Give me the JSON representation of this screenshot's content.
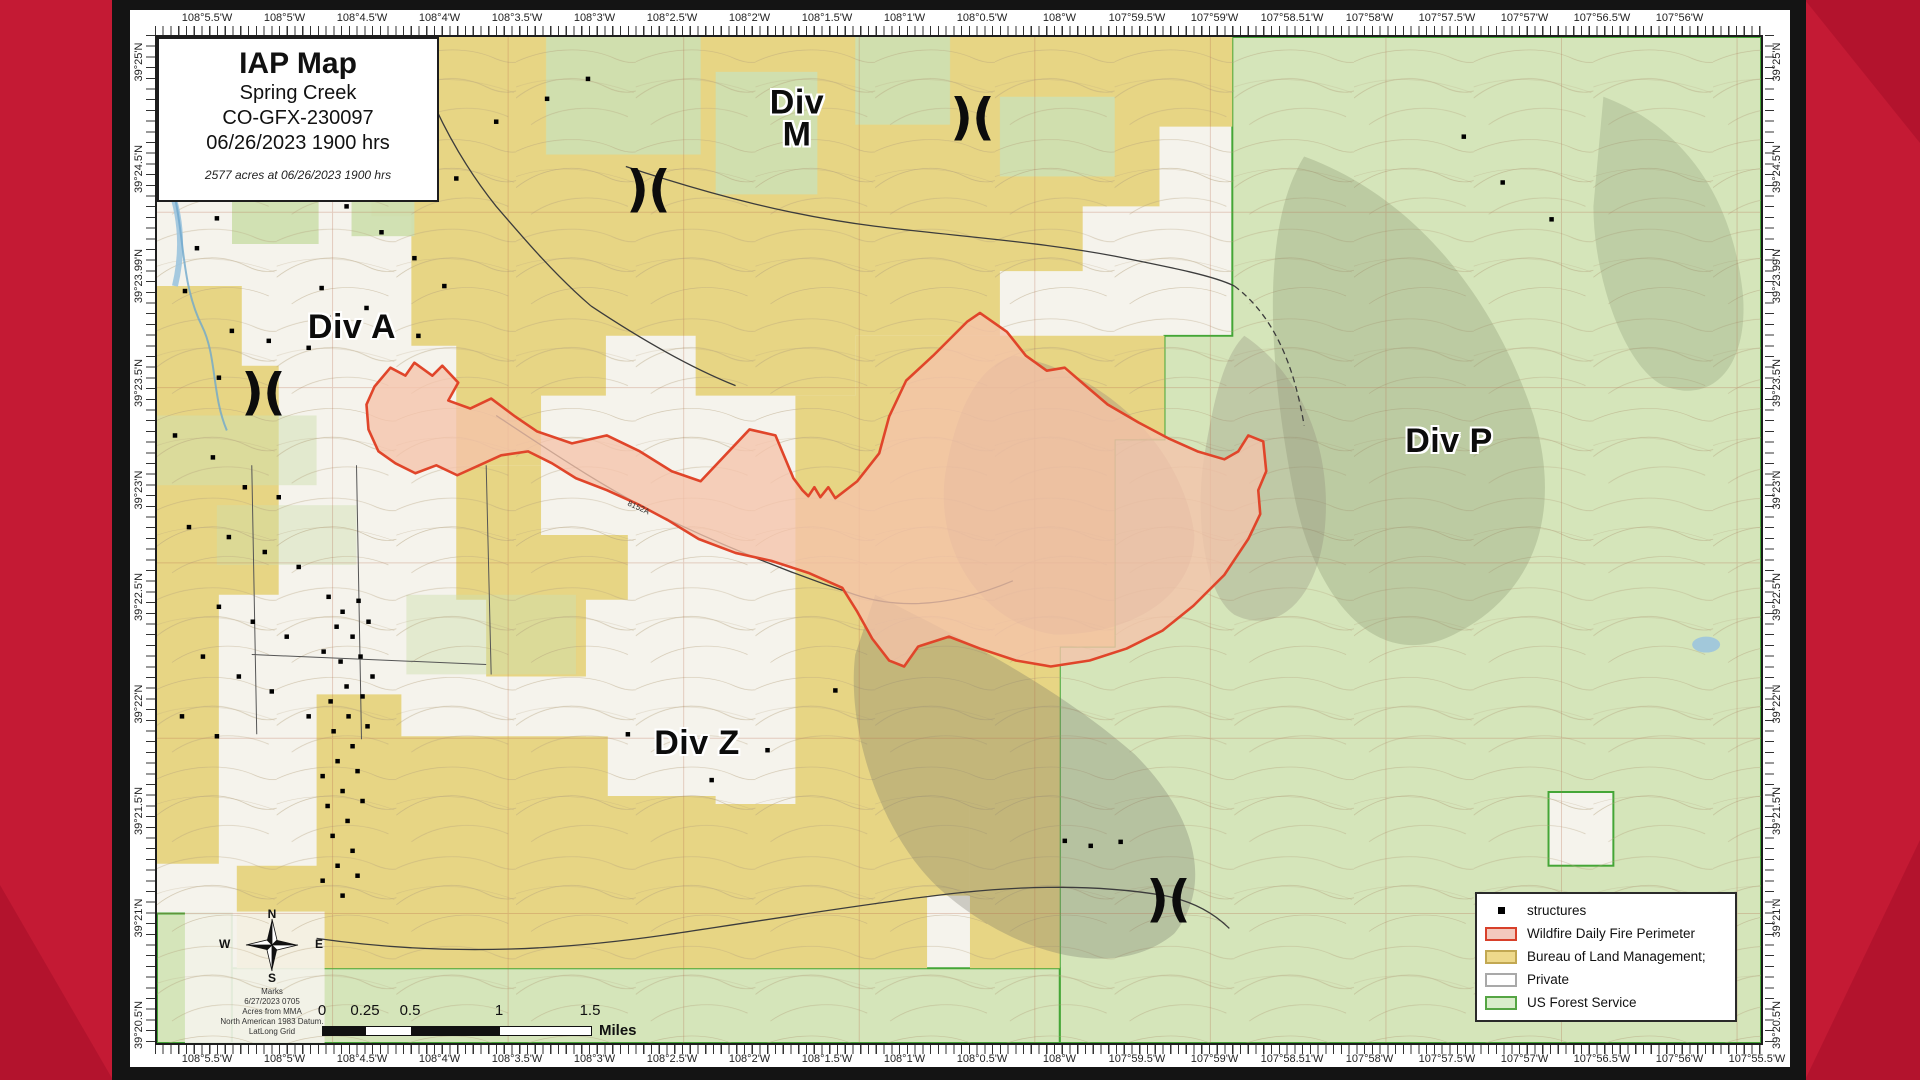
{
  "page": {
    "background_color": "#c41a34",
    "panel_color": "#141414",
    "accent_red": "#e0452a"
  },
  "title_box": {
    "title": "IAP Map",
    "incident_name": "Spring Creek",
    "incident_number": "CO-GFX-230097",
    "datetime": "06/26/2023 1900 hrs",
    "acreage_note": "2577 acres at 06/26/2023 1900 hrs"
  },
  "divisions": [
    {
      "lines": [
        "Div A"
      ],
      "x": 195,
      "y": 290
    },
    {
      "lines": [
        "Div",
        "M"
      ],
      "x": 640,
      "y": 82
    },
    {
      "lines": [
        "Div P"
      ],
      "x": 1292,
      "y": 404
    },
    {
      "lines": [
        "Div Z"
      ],
      "x": 540,
      "y": 706
    }
  ],
  "branch_breaks": {
    "symbol": ")(",
    "positions": [
      {
        "x": 815,
        "y": 80
      },
      {
        "x": 491,
        "y": 152
      },
      {
        "x": 106,
        "y": 355
      },
      {
        "x": 1011,
        "y": 862
      }
    ]
  },
  "legend": {
    "items": [
      {
        "label": "structures",
        "type": "structure"
      },
      {
        "label": "Wildfire Daily Fire Perimeter",
        "type": "swatch",
        "fill": "#f3c9bd",
        "border": "#d8402a"
      },
      {
        "label": "Bureau of Land Management;",
        "type": "swatch",
        "fill": "#eed98b",
        "border": "#c2a852"
      },
      {
        "label": "Private",
        "type": "swatch",
        "fill": "#ffffff",
        "border": "#a9a9a9"
      },
      {
        "label": "US Forest Service",
        "type": "swatch",
        "fill": "#d9edcb",
        "border": "#55a544"
      }
    ]
  },
  "scale_bar": {
    "tick_labels": [
      "0",
      "0.25",
      "0.5",
      "1",
      "1.5"
    ],
    "unit": "Miles"
  },
  "compass": {
    "n": "N",
    "s": "S",
    "e": "E",
    "w": "W",
    "notes": [
      "Marks",
      "6/27/2023 0705",
      "Acres from MMA",
      "North American 1983 Datum.",
      "LatLong Grid"
    ]
  },
  "coordinates": {
    "top": [
      "108°5.5'W",
      "108°5'W",
      "108°4.5'W",
      "108°4'W",
      "108°3.5'W",
      "108°3'W",
      "108°2.5'W",
      "108°2'W",
      "108°1.5'W",
      "108°1'W",
      "108°0.5'W",
      "108°W",
      "107°59.5'W",
      "107°59'W",
      "107°58.51'W",
      "107°58'W",
      "107°57.5'W",
      "107°57'W",
      "107°56.5'W",
      "107°56'W"
    ],
    "bottom": [
      "108°5.5'W",
      "108°5'W",
      "108°4.5'W",
      "108°4'W",
      "108°3.5'W",
      "108°3'W",
      "108°2.5'W",
      "108°2'W",
      "108°1.5'W",
      "108°1'W",
      "108°0.5'W",
      "108°W",
      "107°59.5'W",
      "107°59'W",
      "107°58.51'W",
      "107°58'W",
      "107°57.5'W",
      "107°57'W",
      "107°56.5'W",
      "107°56'W",
      "107°55.5'W"
    ],
    "left": [
      "39°25'N",
      "39°24.5'N",
      "39°23.99'N",
      "39°23.5'N",
      "39°23'N",
      "39°22.5'N",
      "39°22'N",
      "39°21.5'N",
      "39°21'N",
      "39°20.5'N"
    ],
    "right": [
      "39°25'N",
      "39°24.5'N",
      "39°23.99'N",
      "39°23.5'N",
      "39°23'N",
      "39°22.5'N",
      "39°22'N",
      "39°21.5'N",
      "39°21'N",
      "39°20.5'N"
    ]
  },
  "map": {
    "ownership_colors": {
      "blm": "#e7d584",
      "private": "#f5f3ec",
      "usfs": "#d5e5ba",
      "usfs_boundary": "#44a636"
    },
    "fire_perimeter": {
      "stroke": "#e0452a",
      "fill": "#f5c3ab",
      "points": "210,369 218,351 234,332 249,340 258,327 276,340 286,330 302,347 292,365 314,373 335,363 359,381 381,396 416,408 451,400 484,416 516,436 545,446 594,394 620,400 638,443 647,455 653,461 659,452 665,462 673,452 680,463 702,446 724,418 734,381 751,345 778,320 812,286 825,277 852,296 871,320 892,335 910,332 932,351 953,369 984,387 1014,403 1043,416 1070,424 1084,416 1094,400 1109,406 1112,436 1104,455 1106,479 1094,504 1070,540 1039,571 1008,596 972,614 935,626 896,632 861,626 825,614 794,602 763,612 749,632 734,626 717,604 702,577 687,553 653,538 616,526 580,518 543,504 512,485 482,469 451,455 420,443 396,428 372,416 345,420 323,430 301,440 280,430 259,438 239,428 222,416 212,394"
    },
    "road_label": {
      "text": "8152A",
      "x": 470,
      "y": 466,
      "rotate": 24
    },
    "structures": [
      [
        165,
        140
      ],
      [
        190,
        170
      ],
      [
        225,
        196
      ],
      [
        258,
        222
      ],
      [
        288,
        250
      ],
      [
        150,
        115
      ],
      [
        118,
        95
      ],
      [
        95,
        150
      ],
      [
        60,
        182
      ],
      [
        40,
        212
      ],
      [
        28,
        255
      ],
      [
        75,
        295
      ],
      [
        112,
        305
      ],
      [
        152,
        312
      ],
      [
        172,
        282
      ],
      [
        198,
        296
      ],
      [
        62,
        342
      ],
      [
        98,
        362
      ],
      [
        18,
        400
      ],
      [
        56,
        422
      ],
      [
        88,
        452
      ],
      [
        122,
        462
      ],
      [
        32,
        492
      ],
      [
        72,
        502
      ],
      [
        108,
        517
      ],
      [
        142,
        532
      ],
      [
        62,
        572
      ],
      [
        96,
        587
      ],
      [
        130,
        602
      ],
      [
        46,
        622
      ],
      [
        82,
        642
      ],
      [
        115,
        657
      ],
      [
        25,
        682
      ],
      [
        60,
        702
      ],
      [
        152,
        682
      ],
      [
        172,
        562
      ],
      [
        186,
        577
      ],
      [
        202,
        566
      ],
      [
        180,
        592
      ],
      [
        196,
        602
      ],
      [
        212,
        587
      ],
      [
        167,
        617
      ],
      [
        184,
        627
      ],
      [
        204,
        622
      ],
      [
        216,
        642
      ],
      [
        190,
        652
      ],
      [
        174,
        667
      ],
      [
        206,
        662
      ],
      [
        192,
        682
      ],
      [
        177,
        697
      ],
      [
        211,
        692
      ],
      [
        196,
        712
      ],
      [
        181,
        727
      ],
      [
        166,
        742
      ],
      [
        201,
        737
      ],
      [
        186,
        757
      ],
      [
        171,
        772
      ],
      [
        206,
        767
      ],
      [
        191,
        787
      ],
      [
        176,
        802
      ],
      [
        196,
        817
      ],
      [
        181,
        832
      ],
      [
        166,
        847
      ],
      [
        201,
        842
      ],
      [
        186,
        862
      ],
      [
        910,
        807
      ],
      [
        936,
        812
      ],
      [
        966,
        808
      ],
      [
        556,
        746
      ],
      [
        612,
        716
      ],
      [
        1349,
        146
      ],
      [
        1398,
        183
      ],
      [
        1310,
        100
      ],
      [
        340,
        85
      ],
      [
        391,
        62
      ],
      [
        432,
        42
      ],
      [
        300,
        142
      ],
      [
        165,
        252
      ],
      [
        210,
        272
      ],
      [
        262,
        300
      ],
      [
        680,
        656
      ],
      [
        472,
        700
      ]
    ]
  }
}
